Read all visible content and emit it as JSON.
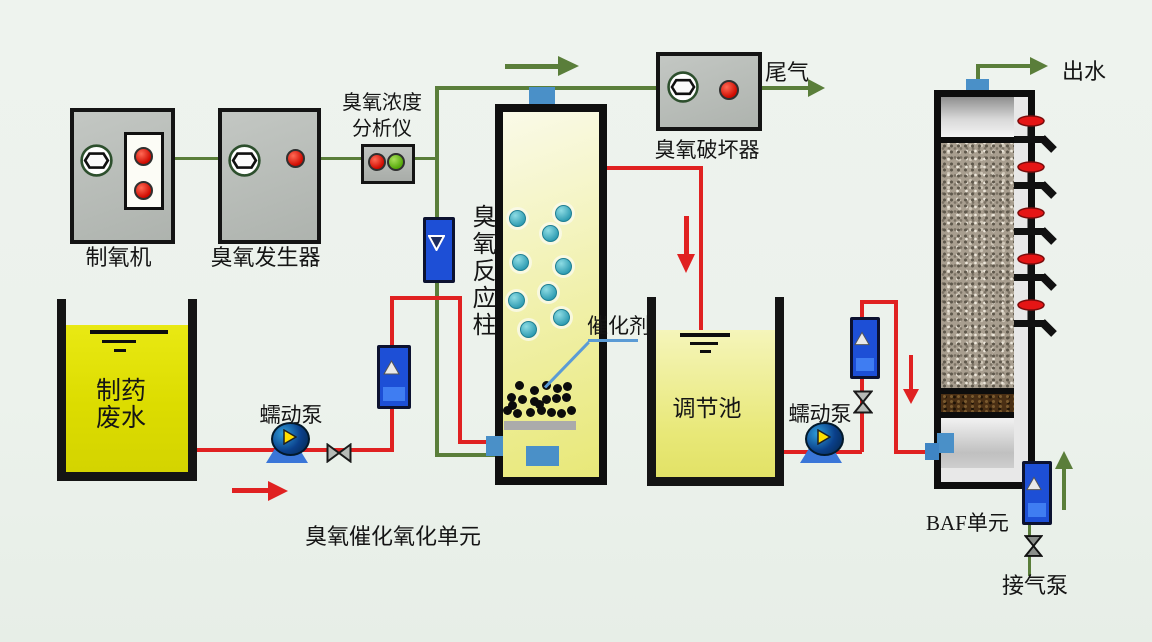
{
  "components": {
    "oxygen_generator": {
      "label": "制氧机"
    },
    "ozone_generator": {
      "label": "臭氧发生器"
    },
    "ozone_analyzer": {
      "label_line1": "臭氧浓度",
      "label_line2": "分析仪"
    },
    "ozone_destructor": {
      "label": "臭氧破坏器"
    },
    "tail_gas": {
      "label": "尾气"
    },
    "reaction_column": {
      "label": "臭氧反应柱"
    },
    "catalyst": {
      "label": "催化剂"
    },
    "wastewater_tank": {
      "label_line1": "制药",
      "label_line2": "废水"
    },
    "pump1": {
      "label": "蠕动泵"
    },
    "regulation_tank": {
      "label": "调节池"
    },
    "pump2": {
      "label": "蠕动泵"
    },
    "section": {
      "label": "臭氧催化氧化单元"
    },
    "baf": {
      "label": "BAF单元",
      "tap_count": 5
    },
    "effluent": {
      "label": "出水"
    },
    "air_pump": {
      "label": "接气泵"
    }
  },
  "colors": {
    "background": "#ecf2ec",
    "pipe_red": "#e02121",
    "pipe_green": "#5a7e3a",
    "machine_grey": "#b9bdb9",
    "wastewater_yellow": "#e2e206",
    "pale_tank_yellow": "#eeeea0",
    "column_yellow": "#ececa0",
    "flowmeter_blue": "#1d4fd6",
    "fitting_blue": "#4a90c8",
    "indicator_red": "#d81000",
    "indicator_green": "#5db01a",
    "catalyst_pointer": "#5b9bd5",
    "tap_handle_red": "#e51515"
  }
}
